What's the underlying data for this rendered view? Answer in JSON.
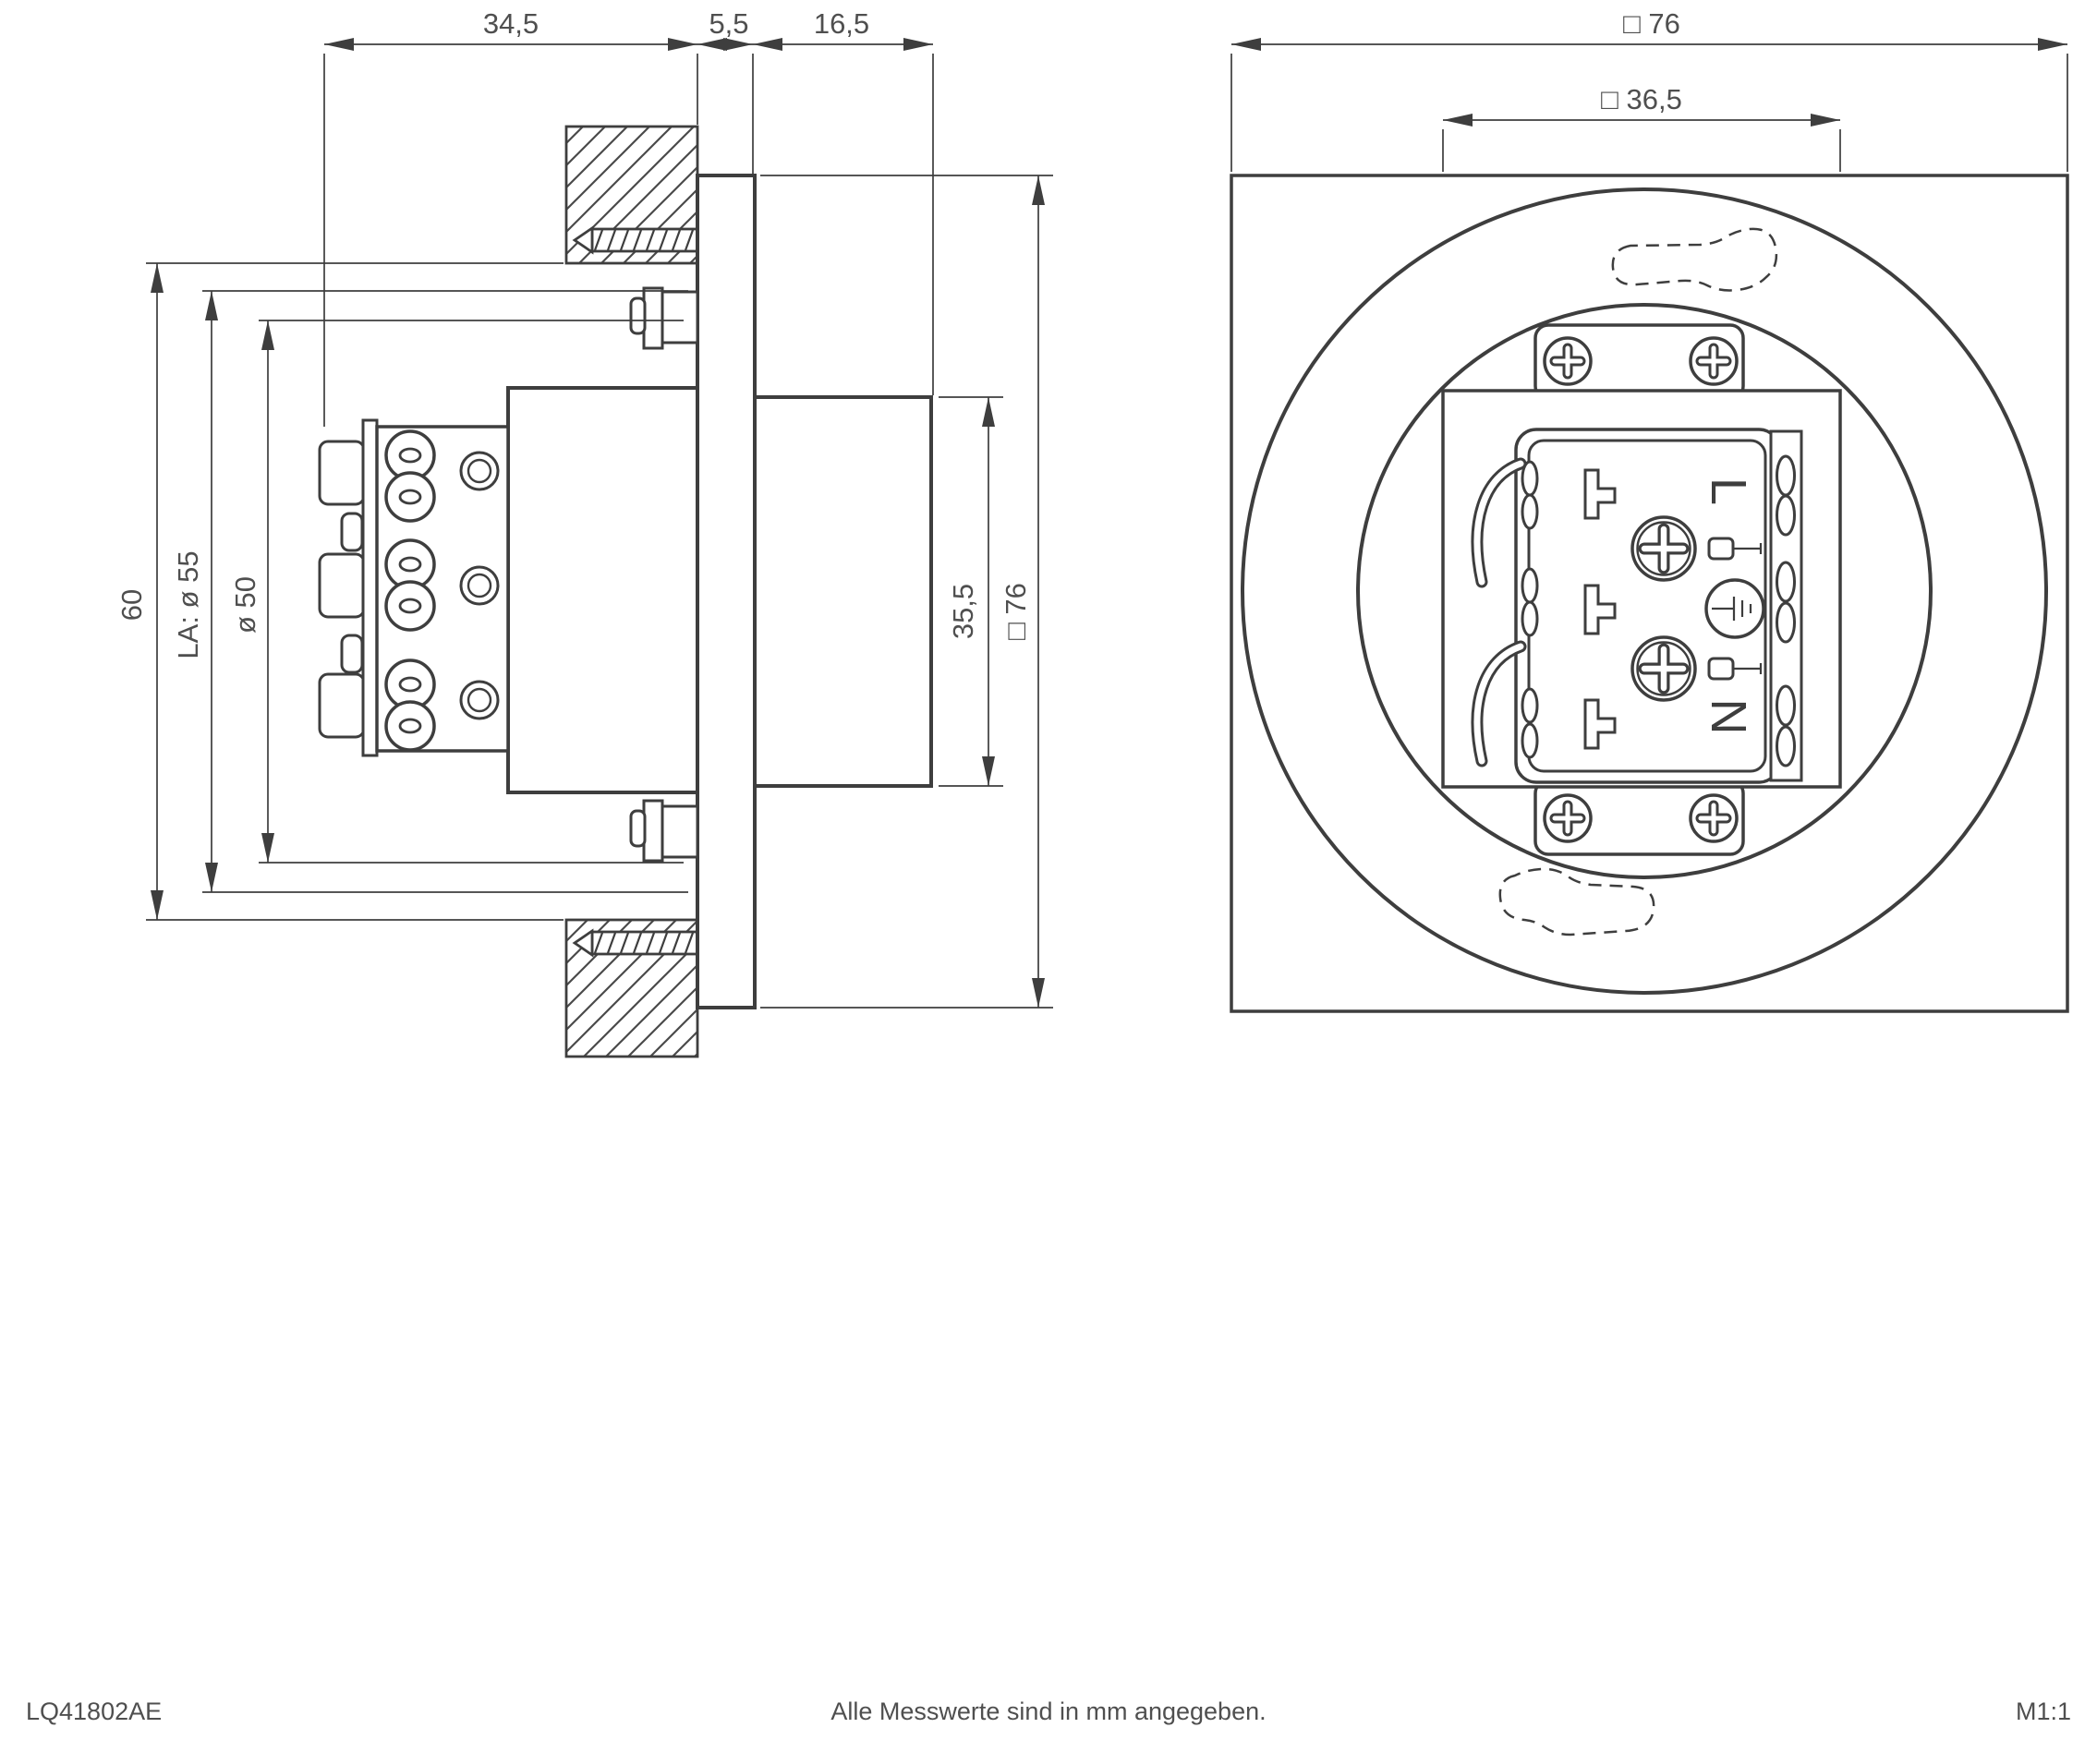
{
  "colors": {
    "line": "#3e3e3e",
    "text": "#4f4f4f",
    "background": "#ffffff"
  },
  "page": {
    "footer_left": "LQ41802AE",
    "footer_center": "Alle Messwerte sind in mm angegeben.",
    "footer_right": "M1:1"
  },
  "side_view": {
    "dim_rear_depth": "34,5",
    "dim_wall_thickness": "5,5",
    "dim_front_depth": "16,5",
    "dim_overall_height": "60",
    "dim_cutout_diameter": "LA: ø 55",
    "dim_body_diameter": "ø 50",
    "dim_front_height": "35,5",
    "dim_plate_size": "□ 76"
  },
  "front_view": {
    "dim_plate_size": "□ 76",
    "dim_inner_square": "□ 36,5",
    "terminal_live": "L",
    "terminal_neutral": "N"
  }
}
